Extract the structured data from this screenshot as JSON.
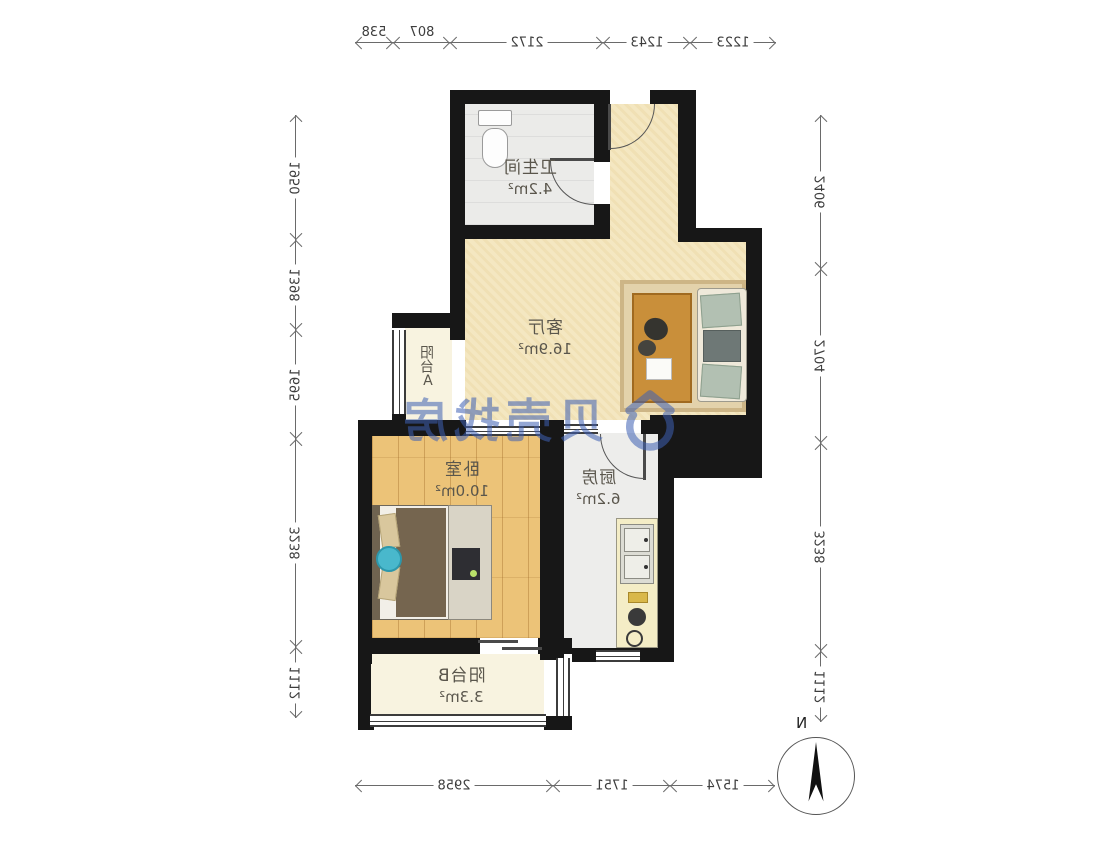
{
  "meta": {
    "type": "floor-plan",
    "orientation": "mirrored",
    "source_watermark": "贝壳找房"
  },
  "rooms": {
    "bathroom": {
      "name": "卫生间",
      "area": "4.2m²"
    },
    "living": {
      "name": "客厅",
      "area": "16.9m²"
    },
    "balconyA": {
      "name": "阳台A"
    },
    "bedroom": {
      "name": "卧室",
      "area": "10.0m²"
    },
    "kitchen": {
      "name": "厨房",
      "area": "6.2m²"
    },
    "balconyB": {
      "name": "阳台B",
      "area": "3.3m²"
    }
  },
  "dims": {
    "top": [
      "538",
      "807",
      "2172",
      "1243",
      "1223"
    ],
    "bottom": [
      "2958",
      "1751",
      "1574"
    ],
    "left": [
      "1950",
      "1398",
      "1695",
      "3238",
      "1112"
    ],
    "right": [
      "2406",
      "2704",
      "3238",
      "1112"
    ]
  },
  "compass": {
    "north_label": "N"
  },
  "watermark": {
    "text": "贝壳找房"
  },
  "colors": {
    "wall": "#171717",
    "living_floor": "#f4e7c1",
    "bedroom_floor": "#ecc378",
    "watermark_blue": "#3e60b4",
    "dimension_line": "#6a6a6a"
  }
}
